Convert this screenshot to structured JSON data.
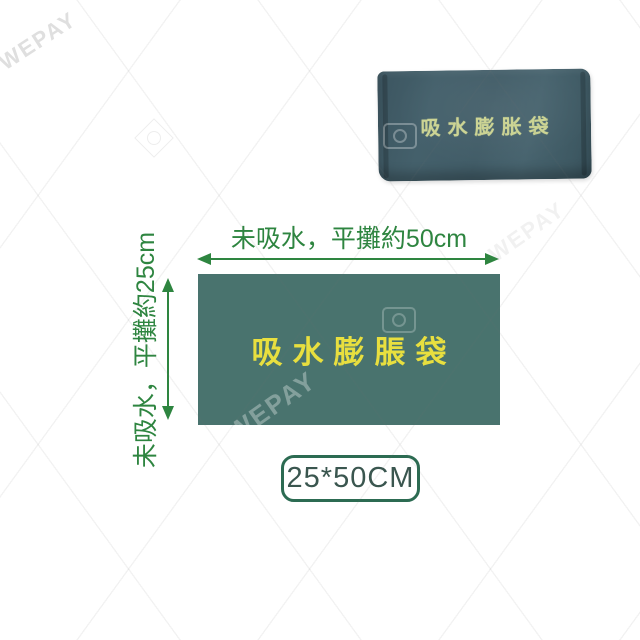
{
  "watermark": {
    "text": "WEPAY"
  },
  "product_photo": {
    "bag_text": "吸水膨胀袋",
    "bag_color": "#425c66",
    "text_color": "#ccd494"
  },
  "diagram": {
    "width_label": "未吸水，平攤約50cm",
    "height_label": "未吸水，平攤約25cm",
    "bag_label": "吸水膨脹袋",
    "rect_color": "#49736e",
    "bag_label_color": "#e8df3f",
    "dimension_color": "#2e8540"
  },
  "size_badge": {
    "label": "25*50CM",
    "text_color": "#3a564f",
    "border_color": "#2c6b52"
  }
}
